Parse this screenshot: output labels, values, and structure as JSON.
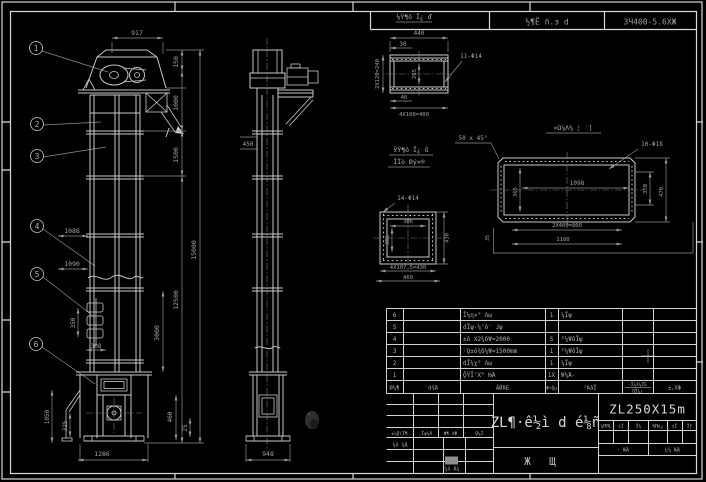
{
  "header": {
    "left": "½¶Ё ñ.з d",
    "right": "3Ч400-5.6ΧЖ"
  },
  "balloons": {
    "b1": "1",
    "b2": "2",
    "b3": "3",
    "b4": "4",
    "b5": "5",
    "b6": "6"
  },
  "front": {
    "d917": "917",
    "d150": "150",
    "d1000": "1000",
    "d1500": "1500",
    "d12500": "12500",
    "d15000": "15000",
    "d1086": "1086",
    "d1090": "1090",
    "d3000": "3000",
    "d350": "350",
    "d308": "308",
    "d1050": "1050",
    "d325": "325",
    "d460": "460",
    "d25": "25",
    "d1286": "1286"
  },
  "side": {
    "d450": "450",
    "d948": "948"
  },
  "d1": {
    "label": "⅛Ϋ¶ô Ī¿ ď",
    "d440": "440",
    "d30": "30",
    "holes": "11-Φ14",
    "d240": "2X120=240",
    "d265": "265",
    "d40": "40",
    "d400": "4X100=400"
  },
  "d2": {
    "l1": "ЎΫ¶ô Ī¿ ů",
    "l2": "ĪÏò Đý×®",
    "holes": "14-Φ14",
    "w": "306",
    "h": "306",
    "right": "430",
    "b1": "4X107.5=430",
    "b2": "460"
  },
  "d3": {
    "label": "¤Ω⅞Λ⅜ ¦ ′]",
    "chamfer": "50 x 45°",
    "holes": "10-Φ18",
    "inner": "1098",
    "h": "365",
    "r1": "350",
    "r2": "470",
    "b1": "2X400=800",
    "b2": "1100",
    "left": "35"
  },
  "bom": {
    "headers": {
      "item": "Ø¼¶",
      "code": "′d¾Ά",
      "name": "ĂǾΆΕ",
      "qty": "Φ↑Ǭμ",
      "material": "²ΆâΪ",
      "weight_top": "·Ĭ¼Χ¼ΪΈ",
      "weight_bottom": "ÓΪ¼¿",
      "remark": "±,ΧΦ"
    },
    "rows": [
      {
        "item": "6",
        "name": "Ĩ¼η×° Λω",
        "qty": "1",
        "material": "¼Ĭψ"
      },
      {
        "item": "5",
        "name": "ɗĨψ·¼″ó′ ɺψ",
        "qty": "",
        "material": ""
      },
      {
        "item": "4",
        "name": "±ô Χ2¾δΨ=2000",
        "qty": "5",
        "material": "°¼ΨôĬψ"
      },
      {
        "item": "3",
        "name": "·Ǫ±ô¾δ¼Ψ=1500mm",
        "qty": "1",
        "material": "°¼ΨôĬψ"
      },
      {
        "item": "2",
        "name": "ɗĨ¼χ° Λω",
        "qty": "1",
        "material": "¼Ĭψ"
      },
      {
        "item": "1",
        "name": "ǬΫĨ″Χ° ǶΆ",
        "qty": "1Χ",
        "material": "Ψ¼Ά·"
      }
    ]
  },
  "tb": {
    "product_name": "ZL¶·ê½ì d é⅛ñ",
    "code": "ZL250X15m",
    "type": "Ж  Щ",
    "sig0": "±¼Ǭ(Ĭ¶",
    "sig1": "¸Ĭψ¼Ă",
    "sig2": "Φ¶ ΧΦ",
    "sig3": "·Ǭ¼Ĩ",
    "row1": "¼ô ¾Ά",
    "row2": "¼ô Ά¼",
    "info0": "¼ĦЯĿ",
    "info1": "±Ī",
    "info2": "Ĭ¼",
    "info3": "ǶĦɳ¿",
    "info4": "±Ĭ",
    "info5": "Ĭƒ",
    "scale": "· ǶΆ",
    "sheet": "Ŀ¼ ǶΆ"
  }
}
